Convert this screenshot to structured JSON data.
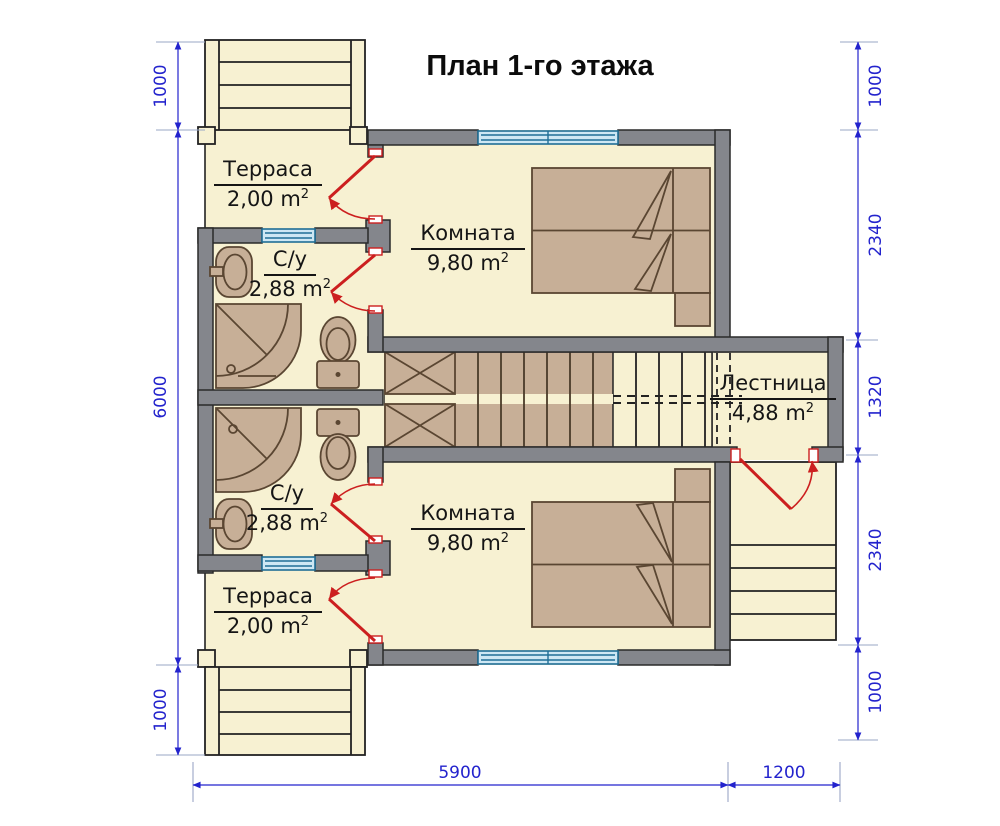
{
  "title": "План 1-го этажа",
  "rooms": {
    "terrace_top": {
      "name": "Терраса",
      "area": "2,00 m",
      "sup": "2"
    },
    "wc_top": {
      "name": "С/у",
      "area": "2,88 m",
      "sup": "2"
    },
    "room_top": {
      "name": "Комната",
      "area": "9,80 m",
      "sup": "2"
    },
    "stairs": {
      "name": "Лестница",
      "area": "4,88 m",
      "sup": "2"
    },
    "wc_bottom": {
      "name": "С/у",
      "area": "2,88 m",
      "sup": "2"
    },
    "terrace_bottom": {
      "name": "Терраса",
      "area": "2,00 m",
      "sup": "2"
    },
    "room_bottom": {
      "name": "Комната",
      "area": "9,80 m",
      "sup": "2"
    }
  },
  "dims": {
    "left": [
      "1000",
      "6000",
      "1000"
    ],
    "right": [
      "1000",
      "2340",
      "1320",
      "2340",
      "1000"
    ],
    "bottom": [
      "5900",
      "1200"
    ]
  },
  "colors": {
    "wall": "#84868c",
    "floor": "#f7f1d2",
    "furniture": "#c7af97",
    "door": "#cc1f1f",
    "window": "#1f6e96",
    "dimension": "#2323cd"
  },
  "symbols": [
    "double-bed",
    "nightstand",
    "shower-tray",
    "toilet",
    "washbasin",
    "staircase",
    "entry-steps",
    "door-swing",
    "window"
  ]
}
